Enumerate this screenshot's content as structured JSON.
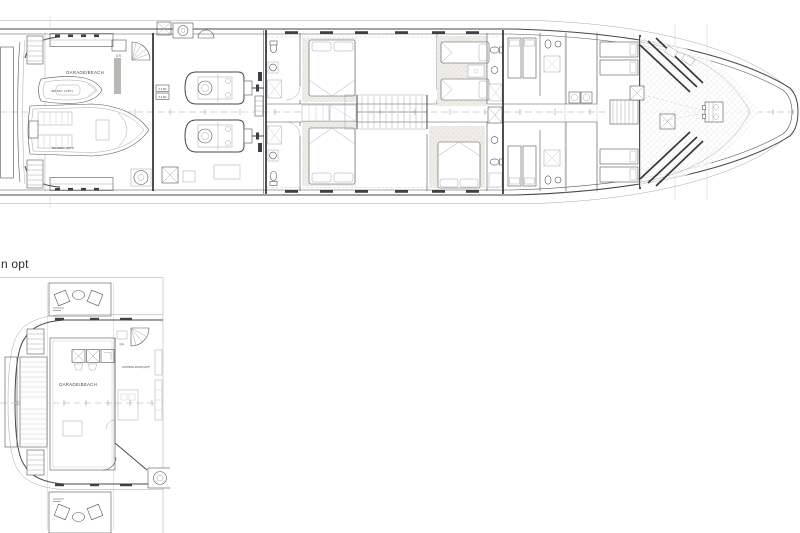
{
  "page": {
    "background": "#ffffff"
  },
  "colors": {
    "line": "#54555a",
    "wall": "#2f3034",
    "platform_gray": "#c8c7c3",
    "carpet": "#efede8"
  },
  "main_plan": {
    "name": "Lower deck plan",
    "labels": {
      "garage_beach": "GARAGE/BEACH",
      "jetski": "JETSKY (OPT)",
      "tender": "TENDER (OPT)",
      "qe": "Q.E.",
      "panel1": "6.2 DD",
      "panel2": "6.2 DD"
    }
  },
  "option_plan": {
    "title": "n opt",
    "labels": {
      "garage_beach": "GARAGE/BEACH",
      "control_room": "CONTROL ROOM (OPT)",
      "qe": "Q.E."
    }
  }
}
